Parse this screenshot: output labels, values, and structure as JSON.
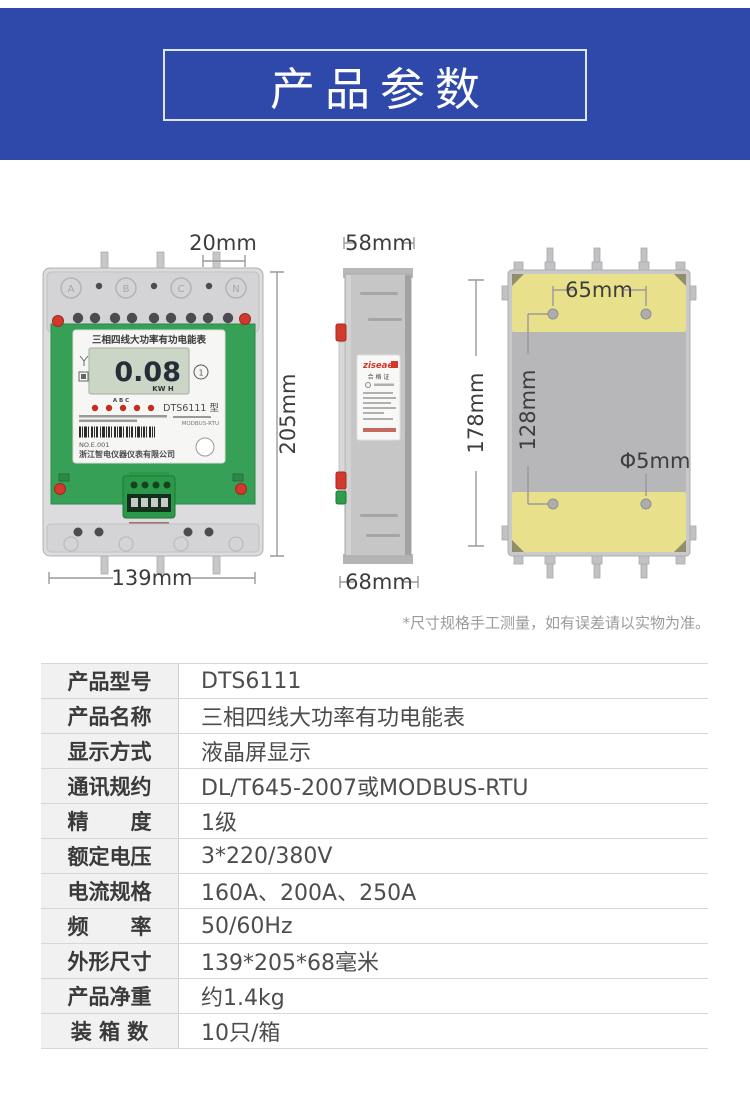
{
  "header": {
    "title": "产品参数",
    "band_color": "#2f49ab"
  },
  "views": {
    "front": {
      "dim_top": "20mm",
      "dim_right": "205mm",
      "dim_bottom": "139mm",
      "panel_title": "三相四线大功率有功电能表",
      "lcd_value": "0.08",
      "lcd_unit": "KW H",
      "badge": "1",
      "indicator_labels": "A    B    C",
      "model": "DTS6111 型",
      "serial": "NO.E.001",
      "protocol": "MODBUS-RTU",
      "company": "浙江智电仪器仪表有限公司",
      "terminals": [
        "A",
        "B",
        "C",
        "N"
      ]
    },
    "side": {
      "dim_top": "58mm",
      "dim_bottom": "68mm",
      "label_logo": "ziseae",
      "label_cert": "合 格 证"
    },
    "back": {
      "dim_height": "178mm",
      "dim_hole_spacing_h": "65mm",
      "dim_hole_spacing_v": "128mm",
      "dim_hole_diameter": "Φ5mm"
    }
  },
  "disclaimer": "*尺寸规格手工测量，如有误差请以实物为准。",
  "spec_table": {
    "rows": [
      {
        "label": "产品型号",
        "value": "DTS6111"
      },
      {
        "label": "产品名称",
        "value": "三相四线大功率有功电能表"
      },
      {
        "label": "显示方式",
        "value": "液晶屏显示"
      },
      {
        "label": "通讯规约",
        "value": "DL/T645-2007或MODBUS-RTU"
      },
      {
        "label": "精　　度",
        "value": "1级"
      },
      {
        "label": "额定电压",
        "value": "3*220/380V"
      },
      {
        "label": "电流规格",
        "value": "160A、200A、250A"
      },
      {
        "label": "频　　率",
        "value": "50/60Hz"
      },
      {
        "label": "外形尺寸",
        "value": "139*205*68毫米"
      },
      {
        "label": "产品净重",
        "value": "约1.4kg"
      },
      {
        "label": "装 箱 数",
        "value": "10只/箱"
      }
    ]
  }
}
